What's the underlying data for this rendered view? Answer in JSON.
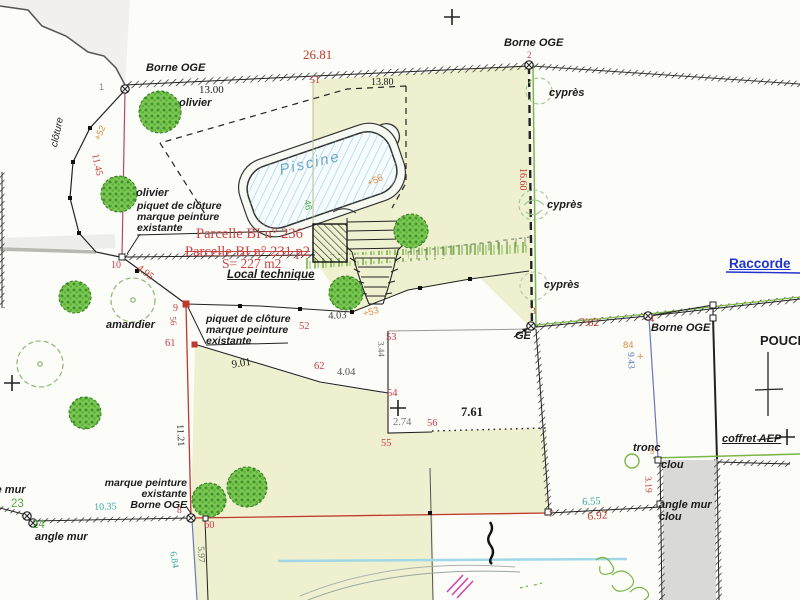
{
  "plan": {
    "type": "plan cadastral / plan de bornage",
    "parcel_current": "Parcelle BI n° 236",
    "parcel_old": "Parcelle BI n° 231 p2",
    "surface": "S= 227 m2"
  },
  "colors": {
    "parcel_fill": "#eef0cf",
    "measure_red": "#c0392b",
    "point_red": "#cc3b47",
    "teal": "#3aa8a0",
    "orange": "#d89040",
    "green_id": "#55aa44",
    "blue_dim": "#5577bb",
    "raccord_blue": "#2233cc",
    "piscine_blue": "#6aa8cc",
    "tree_green": "#4aa32c",
    "magenta_line": "#b5476b",
    "wall_gray": "#d9d9d7"
  },
  "labels": [
    {
      "name": "borne-oge-1-label",
      "text": "Borne OGE",
      "x": 146,
      "y": 63,
      "size": 11,
      "italic": true,
      "bold": true
    },
    {
      "name": "point-1-label",
      "text": "1",
      "x": 99,
      "y": 83,
      "size": 9,
      "color": "#888888"
    },
    {
      "name": "dim-26-81",
      "text": "26.81",
      "x": 303,
      "y": 48,
      "size": 13,
      "color": "#c0392b",
      "serif": true
    },
    {
      "name": "point-51-label",
      "text": "51",
      "x": 310,
      "y": 76,
      "size": 10,
      "color": "#cc3b47",
      "serif": true
    },
    {
      "name": "dim-13-00",
      "text": "13.00",
      "x": 199,
      "y": 85,
      "size": 11,
      "serif": true
    },
    {
      "name": "dim-13-80",
      "text": "13.80",
      "x": 371,
      "y": 78,
      "size": 10,
      "serif": true
    },
    {
      "name": "borne-oge-2-label",
      "text": "Borne OGE",
      "x": 504,
      "y": 38,
      "size": 11,
      "italic": true,
      "bold": true
    },
    {
      "name": "point-2-label",
      "text": "2",
      "x": 527,
      "y": 51,
      "size": 9,
      "color": "#cc3b47",
      "serif": true
    },
    {
      "name": "cypres-1-label",
      "text": "cyprès",
      "x": 549,
      "y": 88,
      "size": 11,
      "italic": true,
      "bold": true
    },
    {
      "name": "dim-16-60",
      "text": "16.60",
      "x": 527,
      "y": 168,
      "size": 10,
      "color": "#c0392b",
      "serif": true,
      "rot": 90
    },
    {
      "name": "cypres-2-label",
      "text": "cyprès",
      "x": 547,
      "y": 200,
      "size": 11,
      "italic": true,
      "bold": true
    },
    {
      "name": "cypres-3-label",
      "text": "cyprès",
      "x": 544,
      "y": 280,
      "size": 11,
      "italic": true,
      "bold": true
    },
    {
      "name": "olivier-1-label",
      "text": "olivier",
      "x": 179,
      "y": 98,
      "size": 11,
      "italic": true,
      "bold": true
    },
    {
      "name": "cloture-label",
      "text": "clôture",
      "x": 50,
      "y": 146,
      "size": 10,
      "italic": true,
      "rot": -78
    },
    {
      "name": "spot-height-52",
      "text": "+52",
      "x": 93,
      "y": 138,
      "size": 9,
      "color": "#d89040",
      "rot": -65
    },
    {
      "name": "dim-11-45",
      "text": "11.45",
      "x": 99,
      "y": 153,
      "size": 10,
      "color": "#c0392b",
      "serif": true,
      "rot": 78
    },
    {
      "name": "olivier-2-label",
      "text": "olivier",
      "x": 136,
      "y": 188,
      "size": 11,
      "italic": true,
      "bold": true
    },
    {
      "name": "piquet-note-1",
      "text": "piquet de clôture\nmarque peinture\nexistante",
      "x": 137,
      "y": 201,
      "size": 10.5,
      "italic": true,
      "bold": true
    },
    {
      "name": "parcelle-236-label",
      "text": "Parcelle BI n° 236",
      "x": 196,
      "y": 227,
      "size": 14.5,
      "color": "#cc4444",
      "serif": true
    },
    {
      "name": "parcelle-231-label",
      "text": "Parcelle BI n° 231 p2",
      "x": 185,
      "y": 245,
      "size": 14.5,
      "color": "#cc4444",
      "serif": true,
      "strike": true
    },
    {
      "name": "surface-label",
      "text": "S= 227 m2",
      "x": 222,
      "y": 257,
      "size": 13.5,
      "color": "#cc4444",
      "serif": true
    },
    {
      "name": "local-technique-label",
      "text": "Local technique",
      "x": 227,
      "y": 269,
      "size": 11.5,
      "italic": true,
      "bold": true,
      "u": true
    },
    {
      "name": "point-10-label",
      "text": "10",
      "x": 111,
      "y": 261,
      "size": 10,
      "color": "#cc3b47",
      "serif": true
    },
    {
      "name": "dim-4-95",
      "text": "4.95",
      "x": 141,
      "y": 263,
      "size": 10.5,
      "color": "#c0392b",
      "serif": true,
      "rot": 37
    },
    {
      "name": "point-9-label",
      "text": "9",
      "x": 173,
      "y": 304,
      "size": 10,
      "color": "#cc3b47",
      "serif": true
    },
    {
      "name": "piquet-note-2",
      "text": "piquet de clôture\nmarque peinture\nexistante",
      "x": 206,
      "y": 314,
      "size": 10.5,
      "italic": true,
      "bold": true
    },
    {
      "name": "point-56-west-label",
      "text": "56",
      "x": 177,
      "y": 316,
      "size": 9,
      "color": "#cc3b47",
      "serif": true,
      "rot": 85
    },
    {
      "name": "point-61-label",
      "text": "61",
      "x": 165,
      "y": 338,
      "size": 10.5,
      "color": "#cc3b47",
      "serif": true
    },
    {
      "name": "amandier-label",
      "text": "amandier",
      "x": 106,
      "y": 320,
      "size": 11,
      "italic": true,
      "bold": true
    },
    {
      "name": "dim-9-01",
      "text": "9.01",
      "x": 231,
      "y": 360,
      "size": 11,
      "serif": true,
      "rot": -9
    },
    {
      "name": "point-62-label",
      "text": "62",
      "x": 314,
      "y": 361,
      "size": 10.5,
      "color": "#cc3b47",
      "serif": true
    },
    {
      "name": "dim-4-04",
      "text": "4.04",
      "x": 337,
      "y": 367,
      "size": 10.5,
      "color": "#555555",
      "serif": true
    },
    {
      "name": "dim-4-03",
      "text": "4.03",
      "x": 328,
      "y": 311,
      "size": 10.5,
      "color": "#444444",
      "serif": true,
      "rot": -3
    },
    {
      "name": "spot-height-53",
      "text": "+53",
      "x": 362,
      "y": 310,
      "size": 9.5,
      "color": "#d89040",
      "rot": -15
    },
    {
      "name": "point-52-east-label",
      "text": "52",
      "x": 299,
      "y": 321,
      "size": 10.5,
      "color": "#cc3b47",
      "serif": true
    },
    {
      "name": "point-53-label",
      "text": "53",
      "x": 386,
      "y": 332,
      "size": 10.5,
      "color": "#cc3b47",
      "serif": true
    },
    {
      "name": "dim-3-44",
      "text": "3.44",
      "x": 385,
      "y": 341,
      "size": 9,
      "color": "#666666",
      "serif": true,
      "rot": 88
    },
    {
      "name": "point-54-label",
      "text": "54",
      "x": 387,
      "y": 388,
      "size": 10.5,
      "color": "#cc3b47",
      "serif": true
    },
    {
      "name": "dim-2-74",
      "text": "2.74",
      "x": 393,
      "y": 417,
      "size": 10.5,
      "color": "#777777",
      "serif": true
    },
    {
      "name": "point-56-label",
      "text": "56",
      "x": 427,
      "y": 418,
      "size": 10.5,
      "color": "#cc3b47",
      "serif": true
    },
    {
      "name": "dim-7-61",
      "text": "7.61",
      "x": 461,
      "y": 406,
      "size": 12.5,
      "bold": true,
      "serif": true
    },
    {
      "name": "point-55-label",
      "text": "55",
      "x": 381,
      "y": 438,
      "size": 10.5,
      "color": "#cc3b47",
      "serif": true
    },
    {
      "name": "dim-11-21",
      "text": "11.21",
      "x": 184,
      "y": 424,
      "size": 10,
      "color": "#333333",
      "serif": true,
      "rot": 87
    },
    {
      "name": "point-3-label",
      "text": "3",
      "x": 531,
      "y": 308,
      "size": 9.5,
      "color": "#cc3b47",
      "serif": true
    },
    {
      "name": "ge-label",
      "text": "GE",
      "x": 515,
      "y": 331,
      "size": 11,
      "bold": true,
      "italic": true
    },
    {
      "name": "dim-7-62",
      "text": "7.62",
      "x": 579,
      "y": 317,
      "size": 11.5,
      "color": "#c0392b",
      "serif": true
    },
    {
      "name": "point-4-label",
      "text": "4",
      "x": 649,
      "y": 314,
      "size": 10.5,
      "color": "#cc3b47",
      "serif": true
    },
    {
      "name": "borne-oge-4-label",
      "text": "Borne OGE",
      "x": 651,
      "y": 323,
      "size": 11,
      "italic": true,
      "bold": true
    },
    {
      "name": "spot-height-84",
      "text": "84",
      "x": 623,
      "y": 341,
      "size": 9.5,
      "color": "#d89040"
    },
    {
      "name": "spot-height-84-plus",
      "text": "+",
      "x": 637,
      "y": 352,
      "size": 11,
      "color": "#d89040"
    },
    {
      "name": "dim-9-43",
      "text": "9.43",
      "x": 634,
      "y": 352,
      "size": 9.5,
      "color": "#5577bb",
      "serif": true,
      "rot": 88
    },
    {
      "name": "raccorde-label",
      "text": "Raccorde",
      "x": 729,
      "y": 257,
      "size": 13.5,
      "color": "#2233cc",
      "bold": true,
      "u": true
    },
    {
      "name": "pouce-label",
      "text": "POUCE",
      "x": 760,
      "y": 334,
      "size": 13,
      "bold": true
    },
    {
      "name": "tronc-label",
      "text": "tronc",
      "x": 633,
      "y": 443,
      "size": 11,
      "italic": true,
      "bold": true
    },
    {
      "name": "clou-label",
      "text": "clou",
      "x": 661,
      "y": 460,
      "size": 11,
      "italic": true,
      "bold": true
    },
    {
      "name": "point-5-label",
      "text": "5",
      "x": 650,
      "y": 448,
      "size": 8,
      "color": "#d89040"
    },
    {
      "name": "dim-3-19",
      "text": "3.19",
      "x": 651,
      "y": 476,
      "size": 9.5,
      "color": "#c0392b",
      "serif": true,
      "rot": 87
    },
    {
      "name": "angle-mur-clou-label",
      "text": "angle mur\nclou",
      "x": 659,
      "y": 500,
      "size": 11,
      "italic": true,
      "bold": true
    },
    {
      "name": "coffret-aep-label",
      "text": "coffret AEP",
      "x": 722,
      "y": 434,
      "size": 11,
      "italic": true,
      "bold": true,
      "u": true
    },
    {
      "name": "dim-6-55",
      "text": "6.55",
      "x": 582,
      "y": 497,
      "size": 10.5,
      "color": "#3aa8a0",
      "serif": true,
      "rot": -3
    },
    {
      "name": "dim-6-92",
      "text": "6.92",
      "x": 587,
      "y": 511,
      "size": 11.5,
      "color": "#c0392b",
      "serif": true,
      "rot": -5
    },
    {
      "name": "point-7-label",
      "text": "7",
      "x": 549,
      "y": 511,
      "size": 9.5,
      "color": "#cc3b47",
      "serif": true
    },
    {
      "name": "point-8-label",
      "text": "8",
      "x": 177,
      "y": 507,
      "size": 9.5,
      "color": "#cc3b47",
      "serif": true
    },
    {
      "name": "marque-peinture-borne-label",
      "text": "marque peinture\nexistante\nBorne OGE",
      "x": 82,
      "y": 478,
      "size": 10.5,
      "italic": true,
      "bold": true,
      "w": 105,
      "align": "right"
    },
    {
      "name": "point-60-label",
      "text": "60",
      "x": 204,
      "y": 520,
      "size": 10.5,
      "color": "#cc3b47",
      "serif": true
    },
    {
      "name": "dim-5-97",
      "text": "5.97",
      "x": 204,
      "y": 546,
      "size": 9.5,
      "color": "#666666",
      "serif": true,
      "rot": 87
    },
    {
      "name": "dim-6-84",
      "text": "6.84",
      "x": 176,
      "y": 551,
      "size": 9.5,
      "color": "#3aa8a0",
      "serif": true,
      "rot": 80
    },
    {
      "name": "dim-10-35",
      "text": "10.35",
      "x": 94,
      "y": 503,
      "size": 10,
      "color": "#3aa8a0",
      "serif": true,
      "rot": -2
    },
    {
      "name": "point-23-label",
      "text": "23",
      "x": 11,
      "y": 498,
      "size": 11.5,
      "color": "#55aa44"
    },
    {
      "name": "point-24-label",
      "text": "24",
      "x": 32,
      "y": 519,
      "size": 11.5,
      "color": "#55aa44"
    },
    {
      "name": "angle-mur-label",
      "text": "angle mur",
      "x": 35,
      "y": 532,
      "size": 11,
      "italic": true,
      "bold": true
    },
    {
      "name": "angle-mur-left-label",
      "text": "angle mur",
      "x": -27,
      "y": 485,
      "size": 11,
      "italic": true,
      "bold": true
    },
    {
      "name": "point-46-label",
      "text": "46",
      "x": 311,
      "y": 199,
      "size": 9.5,
      "color": "#55aa44",
      "rot": 80
    },
    {
      "name": "spot-height-56",
      "text": "+56",
      "x": 366,
      "y": 180,
      "size": 9.5,
      "color": "#d89040",
      "rot": -25
    },
    {
      "name": "piscine-label",
      "text": "Piscine",
      "x": 278,
      "y": 163,
      "size": 15,
      "color": "#6aa8cc",
      "italic": true,
      "rot": -13,
      "ls": 2
    }
  ]
}
